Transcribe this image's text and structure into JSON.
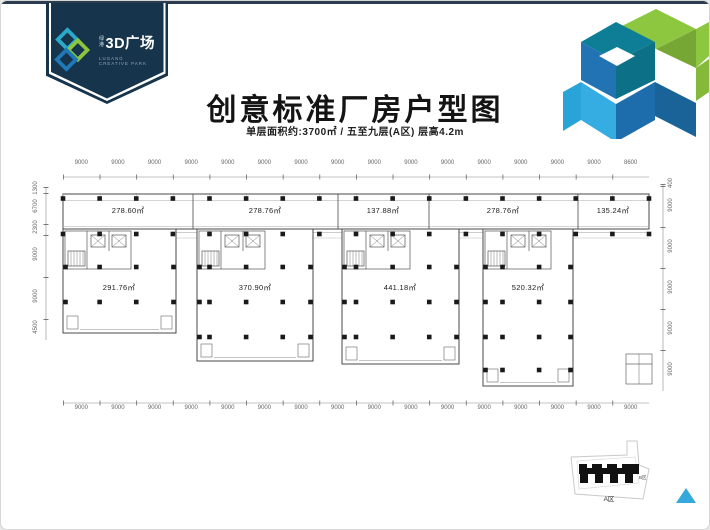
{
  "logo": {
    "brand_small_line1": "绿",
    "brand_small_line2": "港",
    "brand_large": "3D广场",
    "tagline_line1": "LUGANG",
    "tagline_line2": "CREATIVE PARK"
  },
  "header": {
    "title": "创意标准厂房户型图",
    "subtitle": "单层面积约:3700㎡ / 五至九层(A区) 层高4.2m"
  },
  "plan": {
    "top_dims": [
      "9000",
      "9000",
      "9000",
      "9000",
      "9000",
      "9000",
      "9000",
      "9000",
      "9000",
      "9000",
      "9000",
      "9000",
      "9000",
      "9000",
      "9000",
      "8600"
    ],
    "bottom_dims": [
      "9000",
      "9000",
      "9000",
      "9000",
      "9000",
      "9000",
      "9000",
      "9000",
      "9000",
      "9000",
      "9000",
      "9000",
      "9000",
      "9000",
      "9000",
      "9000"
    ],
    "left_dims": [
      "1300",
      "6700",
      "2300",
      "9000",
      "9000",
      "4500"
    ],
    "right_dims": [
      "400",
      "9000",
      "9000",
      "9000",
      "9000",
      "9000"
    ],
    "strip_areas": [
      "278.60㎡",
      "278.76㎡",
      "137.88㎡",
      "278.76㎡",
      "135.24㎡"
    ],
    "wing_areas": [
      "291.76㎡",
      "370.90㎡",
      "441.18㎡",
      "520.32㎡"
    ]
  },
  "keymap": {
    "area_a": "A区",
    "area_b": "B区"
  },
  "colors": {
    "navy": "#16344b",
    "teal": "#0e7e96",
    "green": "#8dc63f",
    "blue": "#2173b4",
    "light_blue": "#29abe2",
    "triangle_blue": "#35a8dc"
  }
}
